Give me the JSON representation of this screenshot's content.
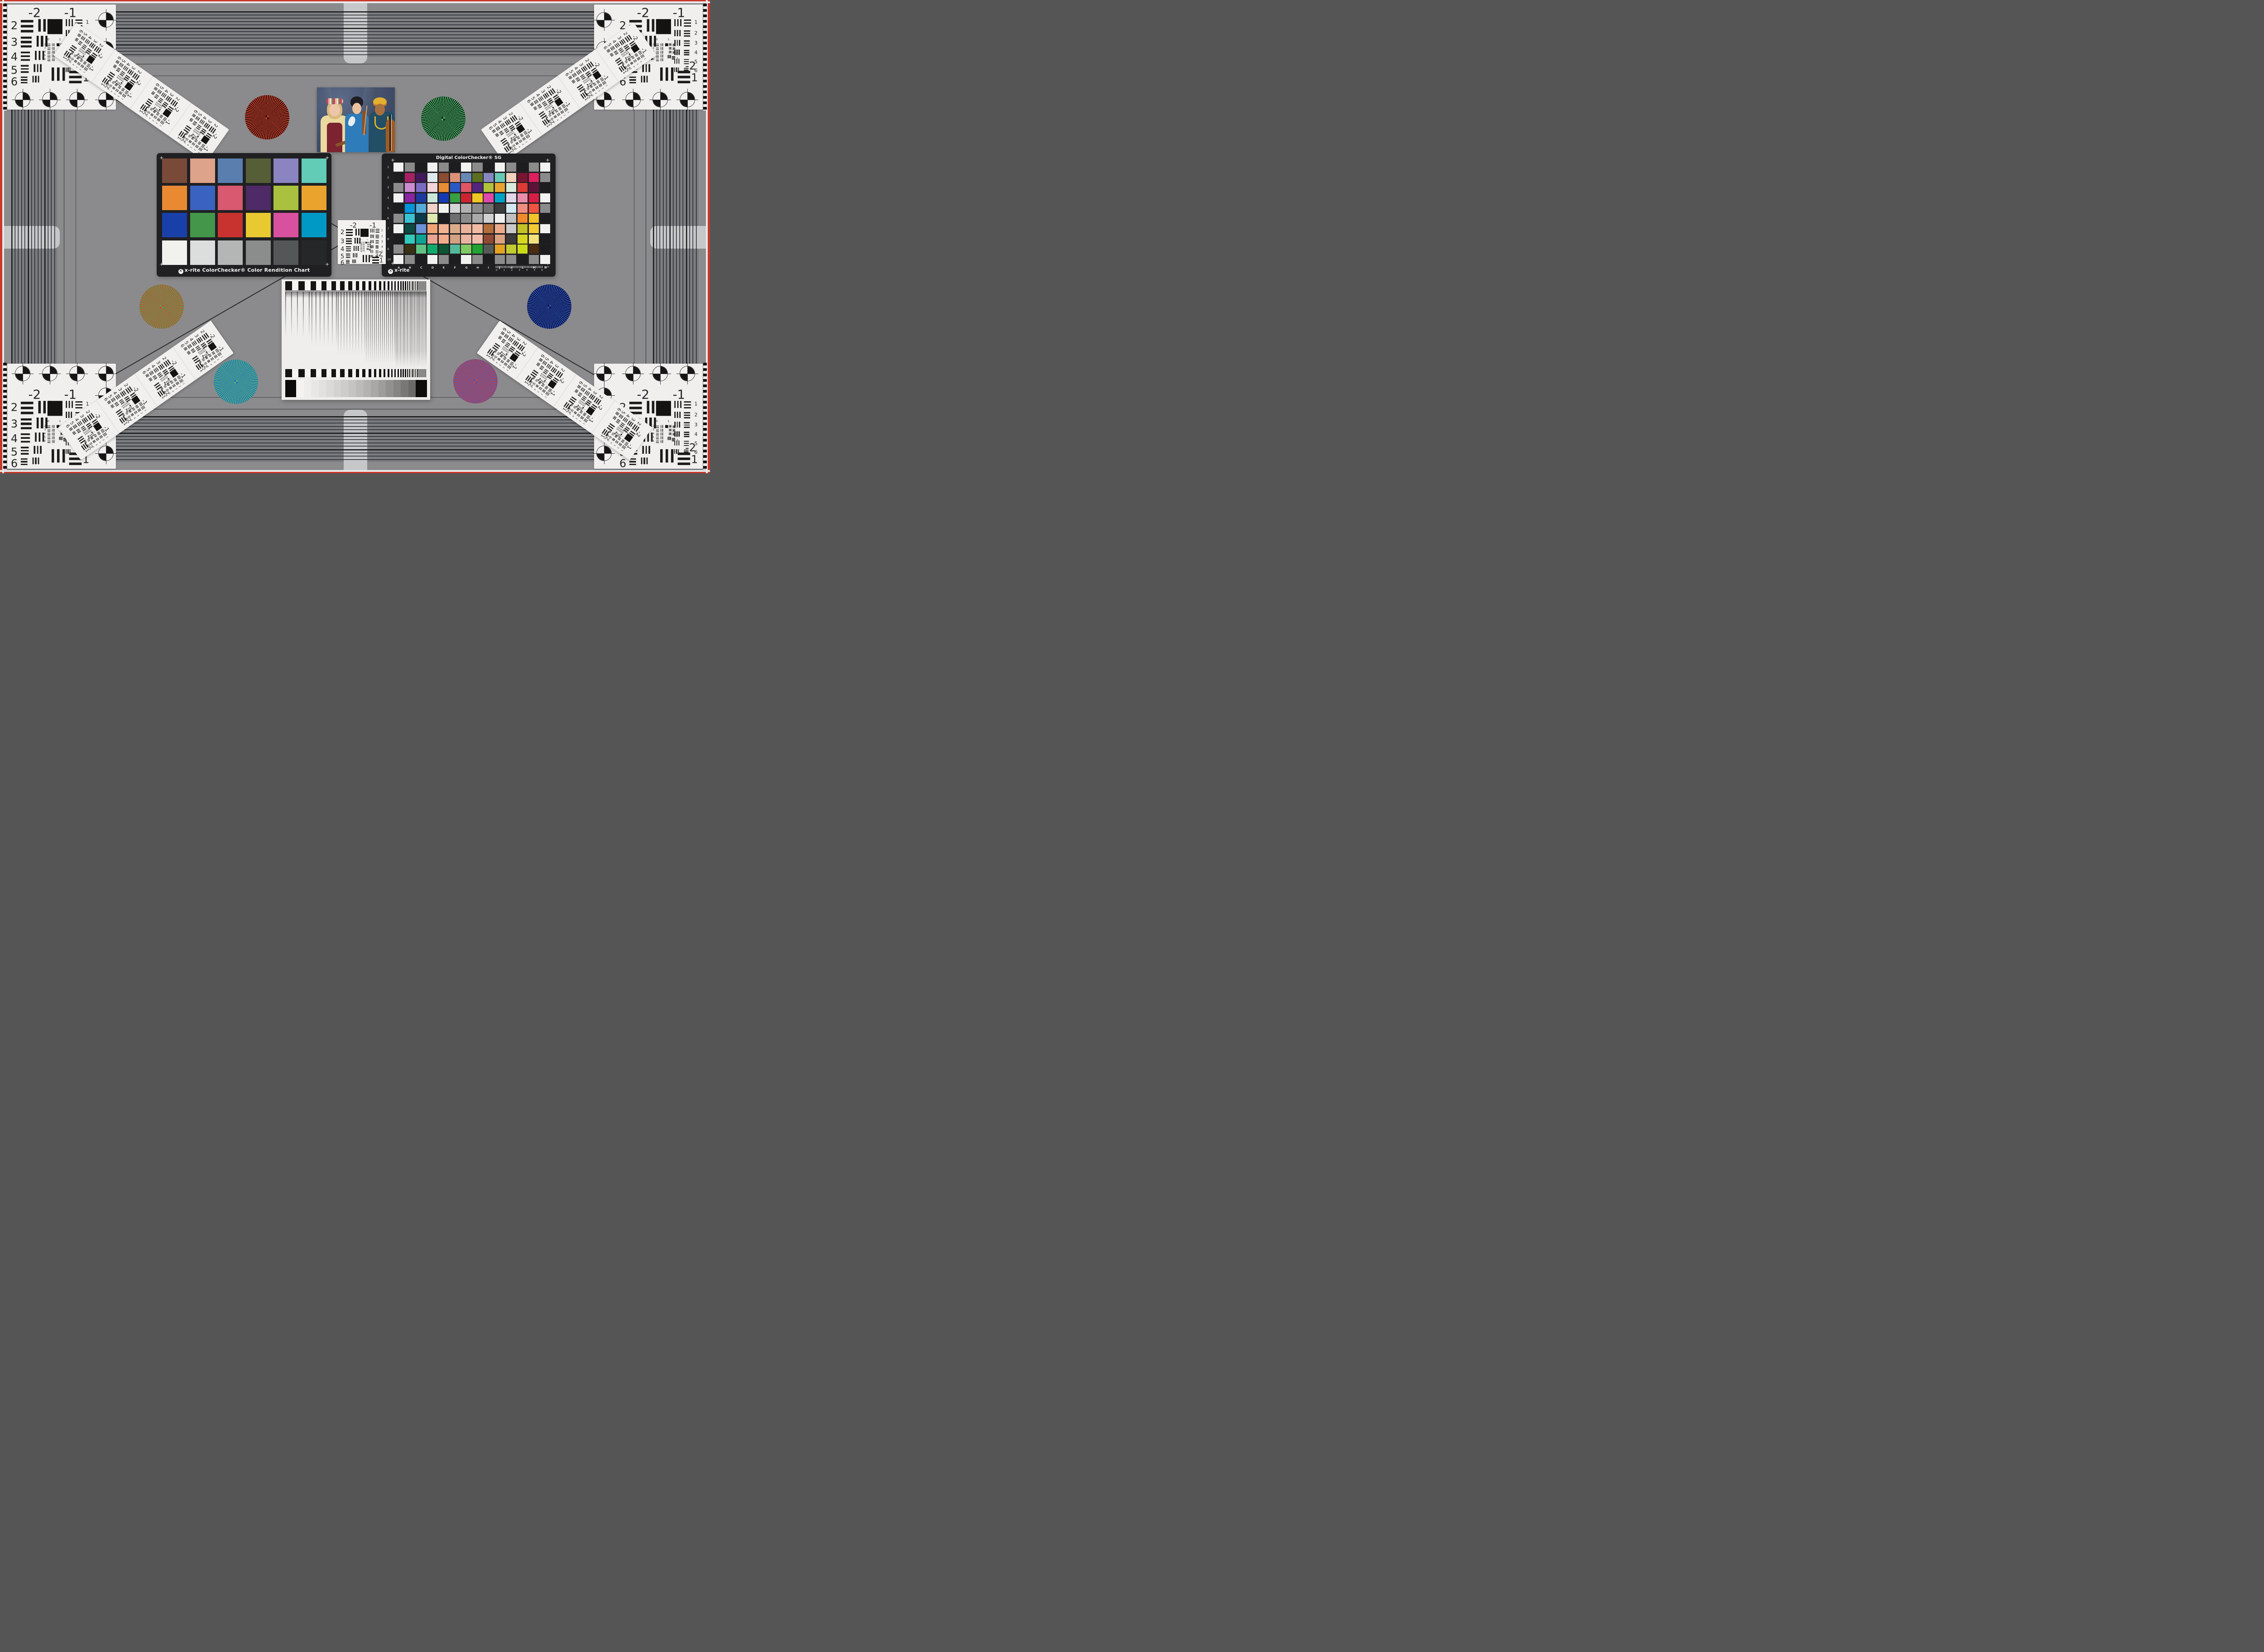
{
  "scene": {
    "description": "Camera studio resolution and color test chart scene"
  },
  "palette": {
    "background": "#8b8b8d",
    "band_bg": "#7c7d80",
    "band_line": "#26272a",
    "band_line_strong": "#17181a",
    "tab": "#c6c7c9",
    "hairline": "#2a2b2e",
    "card_white": "#f1f0ee",
    "card_black": "#202023",
    "frame_red": "#c8382b",
    "frame_white": "#e9eaea",
    "tick_black": "#121212",
    "tick_white": "#ededeb",
    "diag_line": "#2c2d30",
    "chart_ink": "#242424"
  },
  "resolution_chart": {
    "labels_top": [
      "-2",
      "-1"
    ],
    "left_numbers": [
      "2",
      "3",
      "4",
      "5",
      "6"
    ],
    "right_numbers": [
      "1",
      "2",
      "3",
      "4",
      "5",
      "6"
    ],
    "bottom_labels": [
      "-2",
      "1"
    ],
    "mini_numbers": [
      "0",
      "1"
    ],
    "mini_rows": [
      "2",
      "3",
      "4",
      "5",
      "6"
    ]
  },
  "colorchecker24": {
    "caption": "x-rite ColorChecker® Color Rendition Chart",
    "rows": 4,
    "cols": 6,
    "patches": [
      "#7a4a39",
      "#dda38b",
      "#5a7fae",
      "#565e38",
      "#8a85c0",
      "#63ccb6",
      "#e98a33",
      "#3a62c0",
      "#d85970",
      "#4e2a66",
      "#a9c13e",
      "#eaa42e",
      "#1940a8",
      "#43964a",
      "#c8332f",
      "#e8c932",
      "#d7519e",
      "#0098c4",
      "#f1f1ee",
      "#dcdddd",
      "#b3b6b5",
      "#8a8d8c",
      "#545757",
      "#262728"
    ]
  },
  "colorchecker_sg": {
    "title": "Digital ColorChecker® SG",
    "brand": "x-rite",
    "row_labels": [
      "1",
      "2",
      "3",
      "4",
      "5",
      "6",
      "7",
      "8",
      "9",
      "10"
    ],
    "col_labels": [
      "A",
      "B",
      "C",
      "D",
      "E",
      "F",
      "G",
      "H",
      "I",
      "J",
      "K",
      "L",
      "M",
      "N"
    ],
    "ruler_numbers": [
      "0",
      "1",
      "2",
      "3",
      "4",
      "5",
      "6"
    ],
    "ruler_unit": "mm",
    "patches": [
      [
        "#f2f2f1",
        "#8b8b8b",
        "#1d1d1f",
        "#f2f2f1",
        "#8b8b8b",
        "#1d1d1f",
        "#f2f2f1",
        "#8b8b8b",
        "#1d1d1f",
        "#f2f2f1",
        "#8b8b8b",
        "#1d1d1f",
        "#8b8b8b",
        "#f2f2f1"
      ],
      [
        "#1d1d1f",
        "#a62162",
        "#43195c",
        "#dfe8ea",
        "#8a4d33",
        "#dc9179",
        "#6789b4",
        "#5c6e22",
        "#8787c2",
        "#68c8b6",
        "#f0d2bd",
        "#781531",
        "#dd1f5d",
        "#8b8b8b"
      ],
      [
        "#8b8b8b",
        "#cb8bd0",
        "#7a6bc2",
        "#f3d4d8",
        "#e88d33",
        "#2a59c6",
        "#e05465",
        "#54257e",
        "#afc23a",
        "#e8a42e",
        "#d9ecdc",
        "#de3a36",
        "#5e1238",
        "#1d1d1f"
      ],
      [
        "#f2f2f1",
        "#8a24a2",
        "#1c3a9e",
        "#c9e8da",
        "#143bb4",
        "#37a043",
        "#cb2430",
        "#eec722",
        "#df47ab",
        "#00a2c4",
        "#e2d7e8",
        "#ea8cab",
        "#d61e44",
        "#f2f2f1"
      ],
      [
        "#1d1d1f",
        "#0094d8",
        "#56abd8",
        "#f1d2c8",
        "#f2f2f1",
        "#d4d4d4",
        "#b0b0b0",
        "#8b8b8b",
        "#717171",
        "#3c3c3c",
        "#d2e8f2",
        "#f08d82",
        "#ef5440",
        "#8b8b8b"
      ],
      [
        "#8b8b8b",
        "#38c2d2",
        "#0b3a4a",
        "#e0e8b0",
        "#1d1d1f",
        "#6e6e6e",
        "#8b8b8b",
        "#a9a9a9",
        "#d0d0d0",
        "#f0f0ef",
        "#c0c0c0",
        "#f08a2c",
        "#f2c22a",
        "#1d1d1f"
      ],
      [
        "#f2f2f1",
        "#0c4a42",
        "#6b93da",
        "#f2a374",
        "#f2b392",
        "#dcab8b",
        "#eab29b",
        "#f2bba4",
        "#b26d3b",
        "#eaac8b",
        "#c9c9c9",
        "#c2c226",
        "#f2ca33",
        "#f2f2f1"
      ],
      [
        "#1d1d1f",
        "#32cabc",
        "#0fa293",
        "#eaa494",
        "#f2ab8b",
        "#d2a282",
        "#eab3a2",
        "#f2bcab",
        "#8e4a32",
        "#dca282",
        "#3a3a3a",
        "#d6d622",
        "#f2e27c",
        "#1d1d1f"
      ],
      [
        "#8b8b8b",
        "#3a3012",
        "#62c284",
        "#12aa6a",
        "#0c5434",
        "#52ba9a",
        "#82ca62",
        "#22a232",
        "#565a56",
        "#e2a222",
        "#c2ca33",
        "#cada1a",
        "#4a2c12",
        "#1d1d1f"
      ],
      [
        "#f2f2f1",
        "#8b8b8b",
        "#1d1d1f",
        "#f2f2f1",
        "#8b8b8b",
        "#1d1d1f",
        "#f2f2f1",
        "#8b8b8b",
        "#1d1d1f",
        "#8b8b8b",
        "#8b8b8b",
        "#1d1d1f",
        "#8b8b8b",
        "#f2f2f1"
      ]
    ]
  },
  "stars": [
    {
      "name": "star-top-left",
      "colors": [
        "#c8412c",
        "#260c0a"
      ],
      "blend": "#77271b"
    },
    {
      "name": "star-top-right",
      "colors": [
        "#49b469",
        "#0e1a10"
      ],
      "blend": "#2b673c"
    },
    {
      "name": "star-mid-left",
      "colors": [
        "#d8442c",
        "#43a85c"
      ],
      "blend": "#8d7644"
    },
    {
      "name": "star-mid-right",
      "colors": [
        "#2a52c0",
        "#0b0e2c"
      ],
      "blend": "#1a3076"
    },
    {
      "name": "star-bottom-left",
      "colors": [
        "#4cb870",
        "#2a68c2"
      ],
      "blend": "#3b9099"
    },
    {
      "name": "star-bottom-right",
      "colors": [
        "#d8402e",
        "#3a5cc8"
      ],
      "blend": "#894e7b"
    }
  ],
  "portrait": {
    "alt": "Three women musicians with violins and cello against a blue studio backdrop",
    "palette": {
      "backdrop": "#46536e",
      "backdrop_light": "#5c6b89",
      "backdrop_dark": "#36415a",
      "skin_light": "#ecc6a6",
      "skin_mid": "#eac29e",
      "skin_deep": "#a8703f",
      "hair_blonde": "#d9b87c",
      "hair_black": "#1d1d24",
      "blouse_yellow": "#ecd9a0",
      "vest_maroon": "#7b2331",
      "kimono_blue": "#2e7cba",
      "turban_yellow": "#e2b02e",
      "turban_orange": "#c87828",
      "gown_teal": "#224e66",
      "necklace_yellow": "#ddb42a",
      "wood_brown": "#8a5226",
      "cello_brown": "#a05a24"
    }
  },
  "sweep_chart": {
    "wedge_steps": [
      "#0b0b0b",
      "#f4f3f1",
      "#eeedeb",
      "#e8e7e5",
      "#e2e1df",
      "#dbdad8",
      "#d4d3d1",
      "#cdccca",
      "#c5c4c2",
      "#bcbbb9",
      "#b3b2b0",
      "#a9a8a6",
      "#9e9d9b",
      "#93918f",
      "#878583",
      "#7a7876",
      "#6c6a68",
      "#0e0d0c"
    ]
  }
}
